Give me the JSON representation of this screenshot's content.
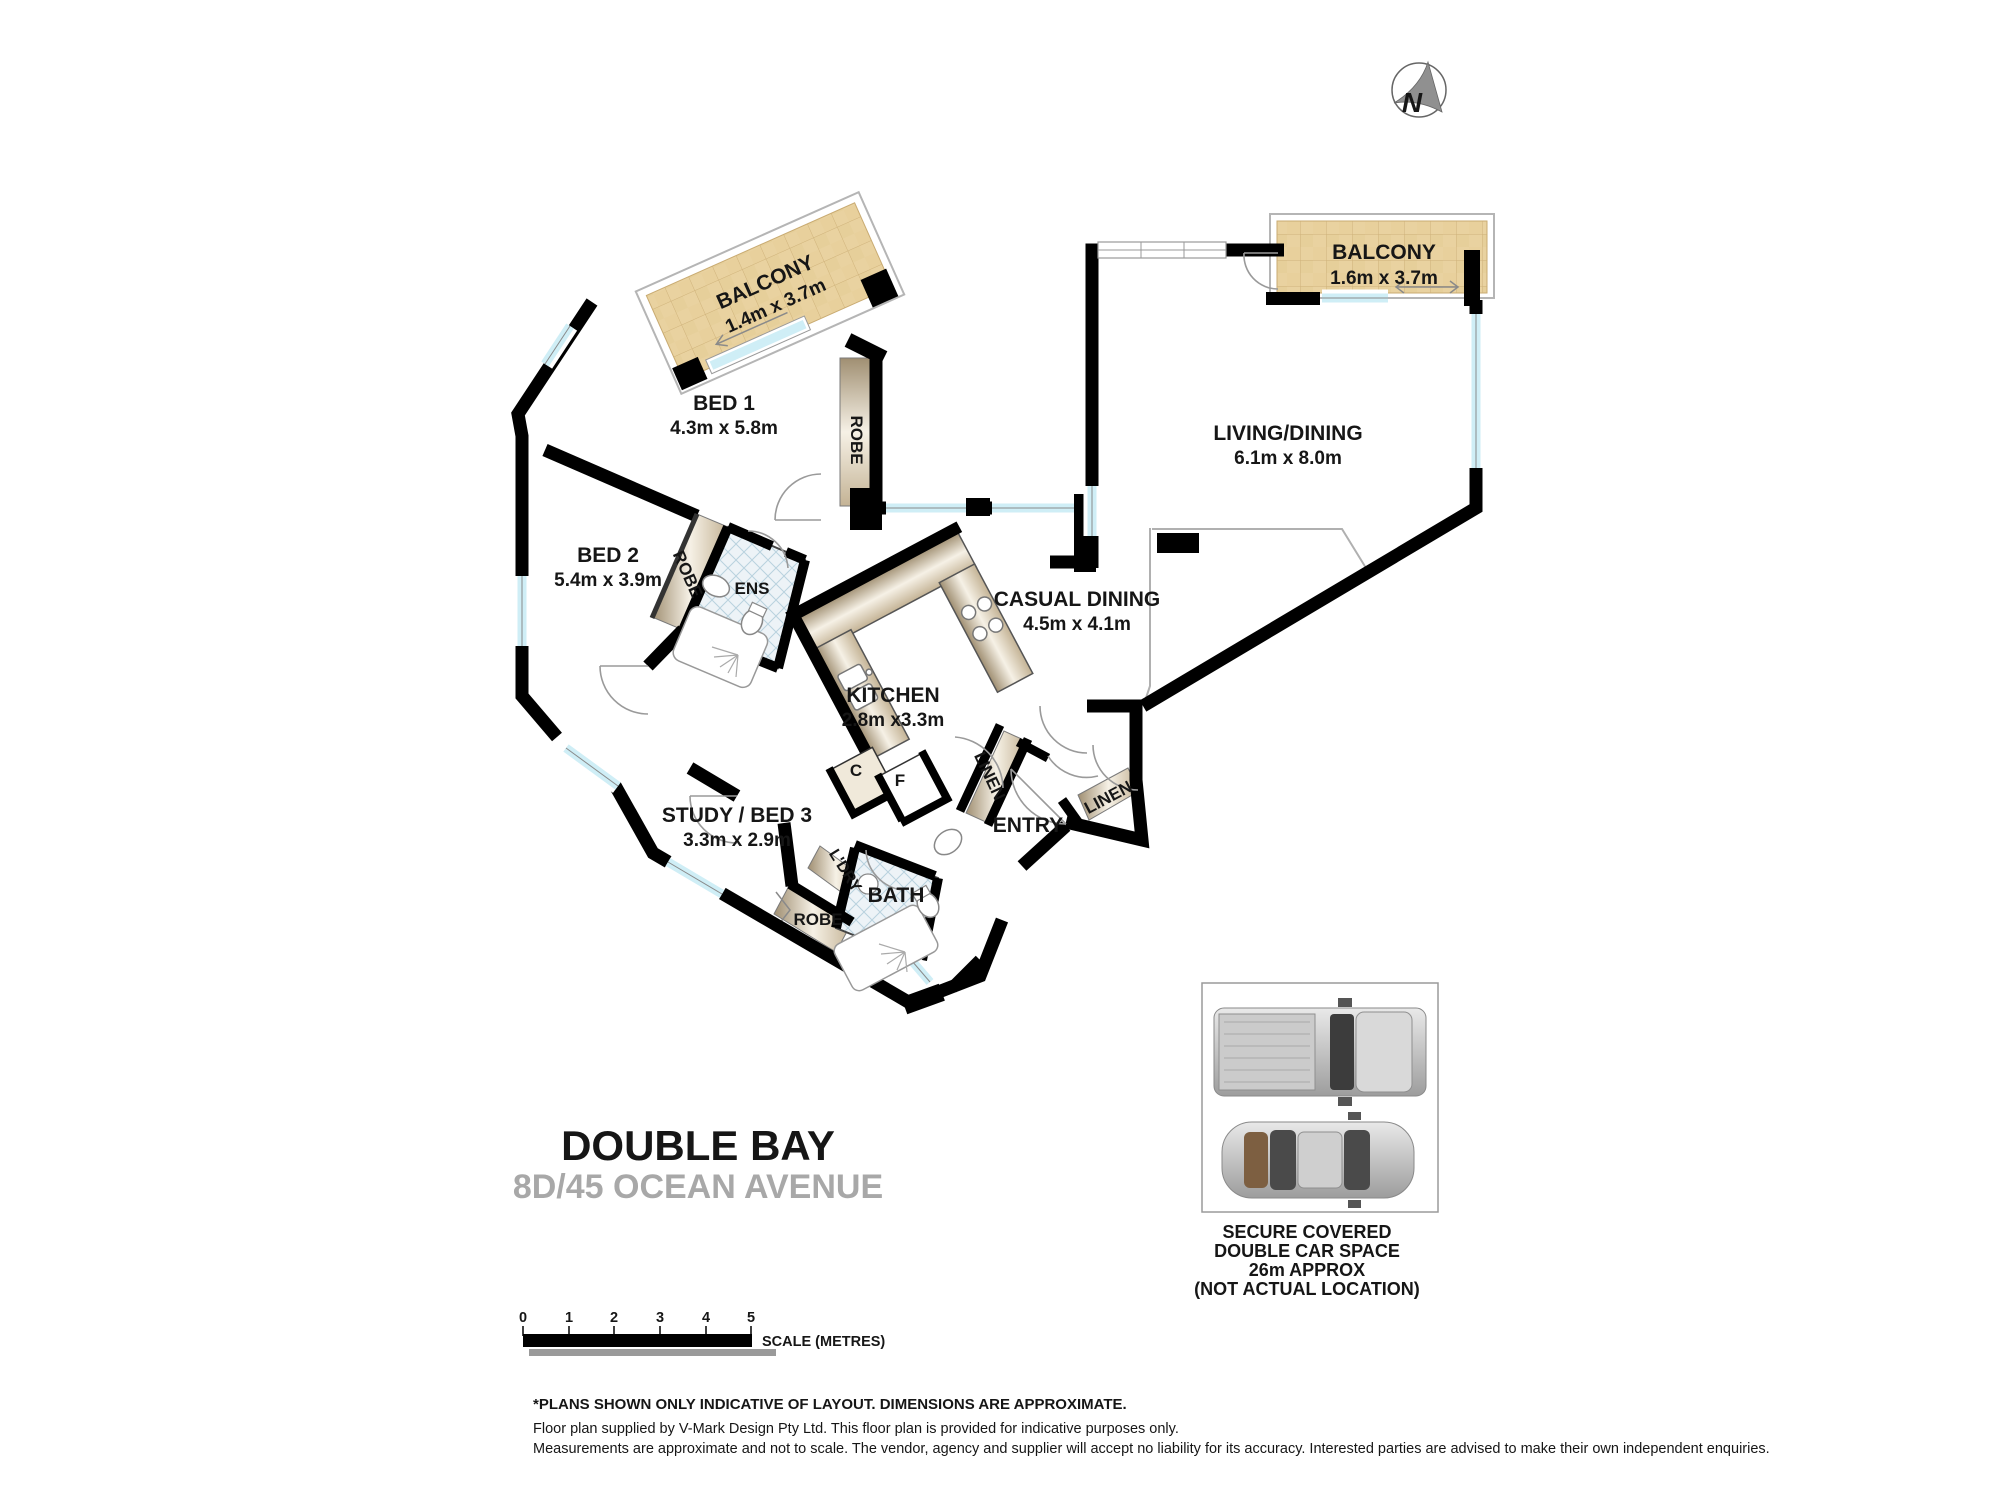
{
  "compass": {
    "letter": "N"
  },
  "rooms": {
    "balcony1": {
      "name": "BALCONY",
      "dims": "1.4m x 3.7m"
    },
    "bed1": {
      "name": "BED 1",
      "dims": "4.3m x 5.8m"
    },
    "robe1": {
      "label": "ROBE"
    },
    "bed2": {
      "name": "BED 2",
      "dims": "5.4m x 3.9m"
    },
    "robe2": {
      "label": "ROBE"
    },
    "ens": {
      "label": "ENS"
    },
    "kitchen": {
      "name": "KITCHEN",
      "dims": "2.8m x3.3m"
    },
    "casual_dining": {
      "name": "CASUAL DINING",
      "dims": "4.5m x 4.1m"
    },
    "living_dining": {
      "name": "LIVING/DINING",
      "dims": "6.1m x 8.0m"
    },
    "balcony2": {
      "name": "BALCONY",
      "dims": "1.6m x 3.7m"
    },
    "cupboard": {
      "label": "C"
    },
    "fridge": {
      "label": "F"
    },
    "linen1": {
      "label": "LINEN"
    },
    "linen2": {
      "label": "LINEN"
    },
    "entry": {
      "label": "ENTRY"
    },
    "study_bed3": {
      "name": "STUDY / BED 3",
      "dims": "3.3m x 2.9m"
    },
    "laundry": {
      "label": "L'DRY"
    },
    "bath": {
      "label": "BATH"
    },
    "robe3": {
      "label": "ROBE"
    }
  },
  "title": {
    "suburb": "DOUBLE BAY",
    "address": "8D/45 OCEAN AVENUE"
  },
  "car_space": {
    "line1": "SECURE COVERED",
    "line2": "DOUBLE CAR SPACE",
    "line3": "26m APPROX",
    "line4": "(NOT ACTUAL LOCATION)"
  },
  "scale_bar": {
    "ticks": [
      "0",
      "1",
      "2",
      "3",
      "4",
      "5"
    ],
    "label": "SCALE (METRES)"
  },
  "disclaimer": {
    "line1": "*PLANS SHOWN ONLY INDICATIVE OF LAYOUT. DIMENSIONS ARE APPROXIMATE.",
    "line2": "Floor plan supplied by V-Mark Design Pty Ltd. This floor plan is provided for indicative purposes only.",
    "line3": "Measurements are approximate and not to scale. The vendor, agency and supplier will accept no liability for its accuracy. Interested parties are advised to make their own independent enquiries."
  },
  "colors": {
    "wall": "#000000",
    "balcony_fill": "#e9d2a0",
    "window_glass": "#cfeef6",
    "strip_light": "#f3eee1",
    "strip_dark": "#a79678",
    "tile_fill": "#edf3f7",
    "title_gray": "#a8a8a8"
  }
}
